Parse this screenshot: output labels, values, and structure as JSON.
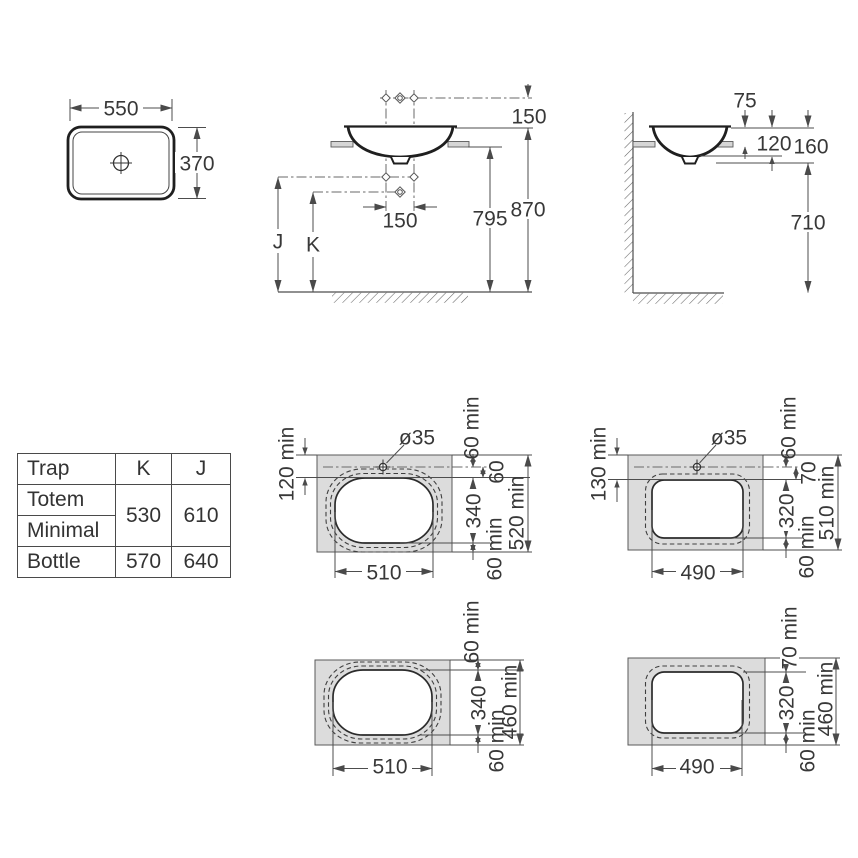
{
  "top_view": {
    "width": "550",
    "depth": "370"
  },
  "front_view": {
    "rim_to_holes": "150",
    "hole_spacing": "150",
    "counter_height": "795",
    "rim_height": "870",
    "trap_j": "J",
    "trap_k": "K"
  },
  "side_view": {
    "above_counter": "75",
    "recess_depth": "120",
    "basin_height": "160",
    "clearance": "710"
  },
  "trap_table": {
    "header_trap": "Trap",
    "header_k": "K",
    "header_j": "J",
    "row_totem": "Totem",
    "row_minimal": "Minimal",
    "row_bottle": "Bottle",
    "totem_minimal_k": "530",
    "totem_minimal_j": "610",
    "bottle_k": "570",
    "bottle_j": "640"
  },
  "cutouts": {
    "oval_with_tap": {
      "hole_dia": "ø35",
      "edge_to_cutout": "120 min",
      "edge_to_hole": "60 min",
      "hole_to_cutout": "60",
      "cutout_depth": "340",
      "rear_margin": "60 min",
      "min_counter_depth": "520 min",
      "cutout_width": "510"
    },
    "rect_with_tap": {
      "hole_dia": "ø35",
      "edge_to_cutout": "130 min",
      "edge_to_hole": "60 min",
      "hole_to_cutout": "70",
      "cutout_depth": "320",
      "rear_margin": "60 min",
      "min_counter_depth": "510 min",
      "cutout_width": "490"
    },
    "oval_no_tap": {
      "front_margin": "60 min",
      "cutout_depth": "340",
      "rear_margin": "60 min",
      "min_counter_depth": "460 min",
      "cutout_width": "510"
    },
    "rect_no_tap": {
      "front_margin": "70 min",
      "cutout_depth": "320",
      "rear_margin": "60 min",
      "min_counter_depth": "460 min",
      "cutout_width": "490"
    }
  },
  "colors": {
    "counter_fill": "#dcdcdc",
    "line": "#4d4d4d",
    "text": "#383838"
  }
}
